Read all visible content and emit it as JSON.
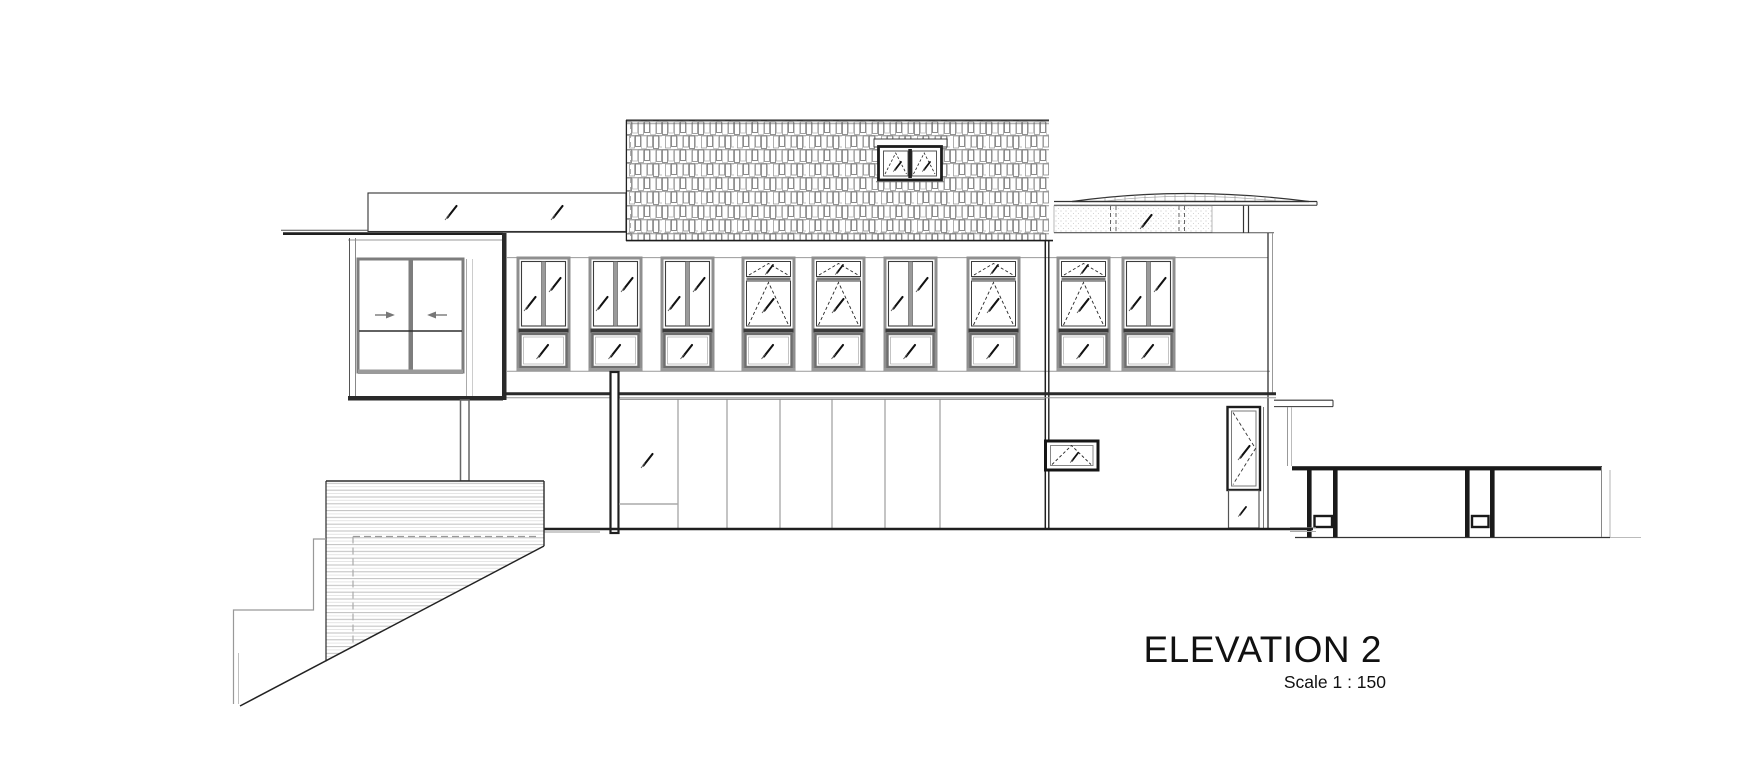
{
  "title_block": {
    "title": "ELEVATION 2",
    "scale_label": "Scale 1 : 150"
  },
  "drawing": {
    "type_label": "architectural elevation",
    "upper_window_count": "9",
    "dormer_window_count": "1"
  },
  "colors": {
    "background": "#ffffff",
    "ink": "#1f1f1f",
    "gray": "#8f8f8f",
    "light_gray": "#c6c6c6"
  }
}
